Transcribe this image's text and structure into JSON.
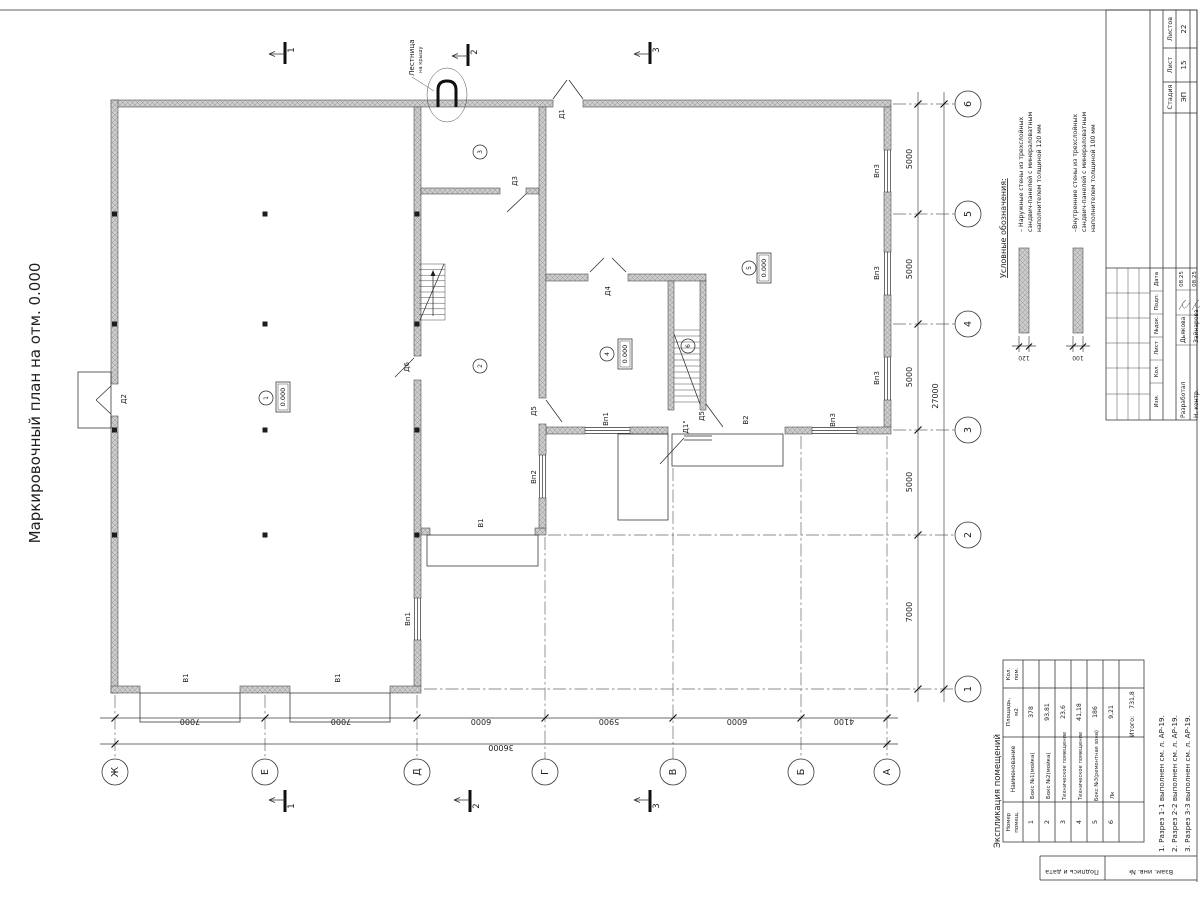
{
  "sheet": {
    "title": "Маркировочный план на отм. 0.000",
    "stamp": {
      "stage_label": "Стадия",
      "sheet_label": "Лист",
      "sheets_label": "Листов",
      "stage": "ЭП",
      "sheet_num": "15",
      "sheets_total": "22",
      "cols": [
        "Изм.",
        "Кол.",
        "Лист",
        "№док.",
        "Подп.",
        "Дата"
      ],
      "rows": [
        {
          "role": "Разработал",
          "name": "Дьякова",
          "date": "08.25"
        },
        {
          "role": "Н. контр.",
          "name": "Зайнарова",
          "date": "08.25"
        }
      ],
      "side_labels": [
        "Подпись и дата",
        "Взам. инв. №"
      ]
    },
    "notes": [
      "1. Разрез 1-1 выполнен см. л. АР-19.",
      "2. Разрез 2-2 выполнен см. л. АР-19.",
      "3. Разрез 3-3 выполнен см. л. АР-19."
    ]
  },
  "legend": {
    "heading": "Условные обозначения:",
    "items": [
      {
        "lines": [
          "– Наружные стены из трехслойных",
          "сэндвич-панелей с минераловатным",
          "наполнителем толщиной 120 мм"
        ],
        "dim": "120"
      },
      {
        "lines": [
          "–Внутренние стены из трехслойных",
          "сэндвич-панелей с минераловатным",
          "наполнителем толщиной 100 мм"
        ],
        "dim": "100"
      }
    ]
  },
  "plan": {
    "axis_letters": [
      "Ж",
      "Е",
      "Д",
      "Г",
      "В",
      "Б",
      "А"
    ],
    "axis_numbers": [
      "6",
      "5",
      "4",
      "3",
      "2",
      "1"
    ],
    "dims_bottom": [
      "7000",
      "7000",
      "6000",
      "5900",
      "6000",
      "4100"
    ],
    "total_bottom": "36000",
    "dims_right": [
      "5000",
      "5000",
      "5000",
      "5000",
      "7000"
    ],
    "total_right": "27000",
    "sections": [
      "1",
      "2",
      "3"
    ],
    "rooms": [
      "1",
      "2",
      "3",
      "4",
      "5",
      "6"
    ],
    "elev": "0.000",
    "ladder": [
      "Лестница",
      "на крышу"
    ],
    "labels": {
      "d1": "Д1",
      "d2": "Д2",
      "d3": "Д3",
      "d4": "Д4",
      "d5": "Д5",
      "d6": "Д6",
      "d1s": "Д1\"",
      "v1": "В1",
      "v2": "В2",
      "vp1": "Вп1",
      "vp2": "Вп2",
      "vp3": "Вп3"
    }
  },
  "room_table": {
    "title": "Экспликация помещений",
    "headers": {
      "num1": "Номер",
      "num2": "помещ.",
      "name": "Наименование",
      "area1": "Площадь,",
      "area2": "м2",
      "count1": "Кол.",
      "count2": "пом."
    },
    "rows": [
      {
        "num": "1",
        "name": "Бокс №1(мойка)",
        "area": "378"
      },
      {
        "num": "2",
        "name": "Бокс №2(мойка)",
        "area": "93,81"
      },
      {
        "num": "3",
        "name": "Техническое помещение",
        "area": "23,6"
      },
      {
        "num": "4",
        "name": "Техническое помещение",
        "area": "41,18"
      },
      {
        "num": "5",
        "name": "Бокс №3(ремонтная зона)",
        "area": "186"
      },
      {
        "num": "6",
        "name": "Лк",
        "area": "9,21"
      }
    ],
    "total_label": "Итого:",
    "total_value": "731,8"
  }
}
